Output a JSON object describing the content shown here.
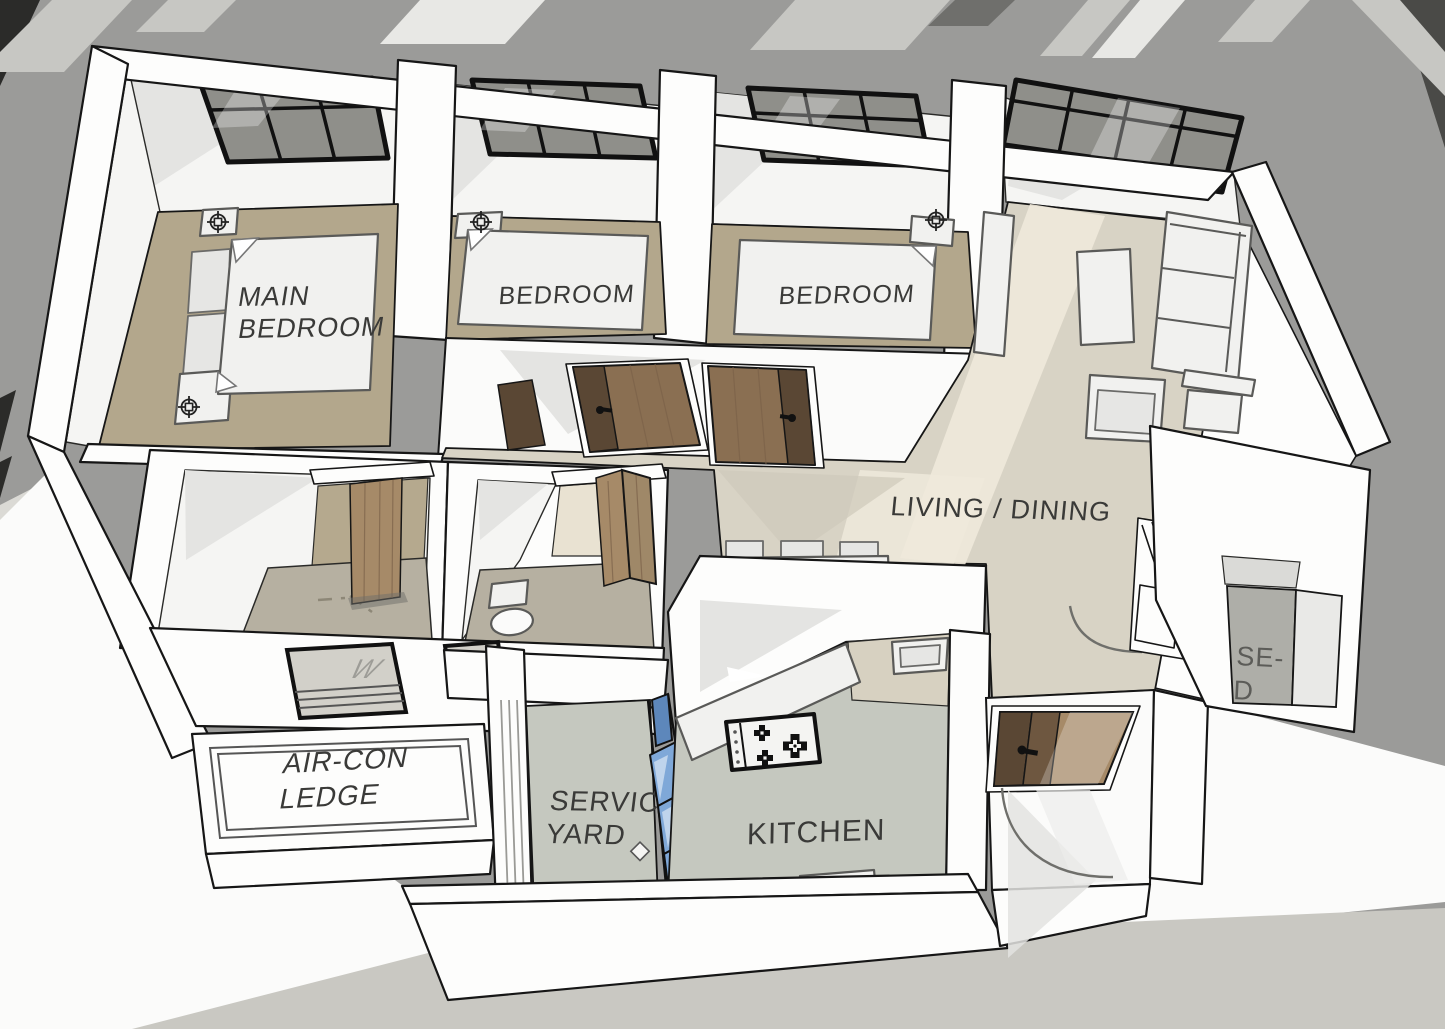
{
  "title": "3D apartment floor plan rendering",
  "labels": {
    "main_bedroom_line1": "MAIN",
    "main_bedroom_line2": "BEDROOM",
    "bedroom_2": "BEDROOM",
    "bedroom_3": "BEDROOM",
    "living_dining": "LIVING / DINING",
    "aircon_line1": "AIR-CON",
    "aircon_line2": "LEDGE",
    "service_yard_line1": "SERVICE",
    "service_yard_line2": "YARD",
    "kitchen": "KITCHEN",
    "shelter_partial_line1": "SE-",
    "shelter_partial_line2": "D",
    "window_letter": "W"
  },
  "colors": {
    "background": "#9b9b99",
    "ground_light": "#dbdad5",
    "ground_bottom": "#c9c8c2",
    "wall": "#fdfdfc",
    "wall_shadow": "#e4e4e2",
    "outline": "#161616",
    "bedroom_floor": "#b3a78c",
    "living_floor": "#d8d3c5",
    "living_floor_light": "#efe9da",
    "bathroom_floor": "#b6b0a1",
    "kitchen_floor": "#c5c8bf",
    "shelter_floor": "#aeaea8",
    "window_glass": "#8f8f8a",
    "door_wood": "#8a6f52",
    "door_wood_dark": "#5a4734",
    "door_wood_light": "#a68a68",
    "glass_blue": "#7fa8d8",
    "label_text": "#3a3a38"
  },
  "icons": {
    "lamp_symbol": "ceiling-lamp-crosshair",
    "burner_symbol": "stove-burner-cross"
  }
}
